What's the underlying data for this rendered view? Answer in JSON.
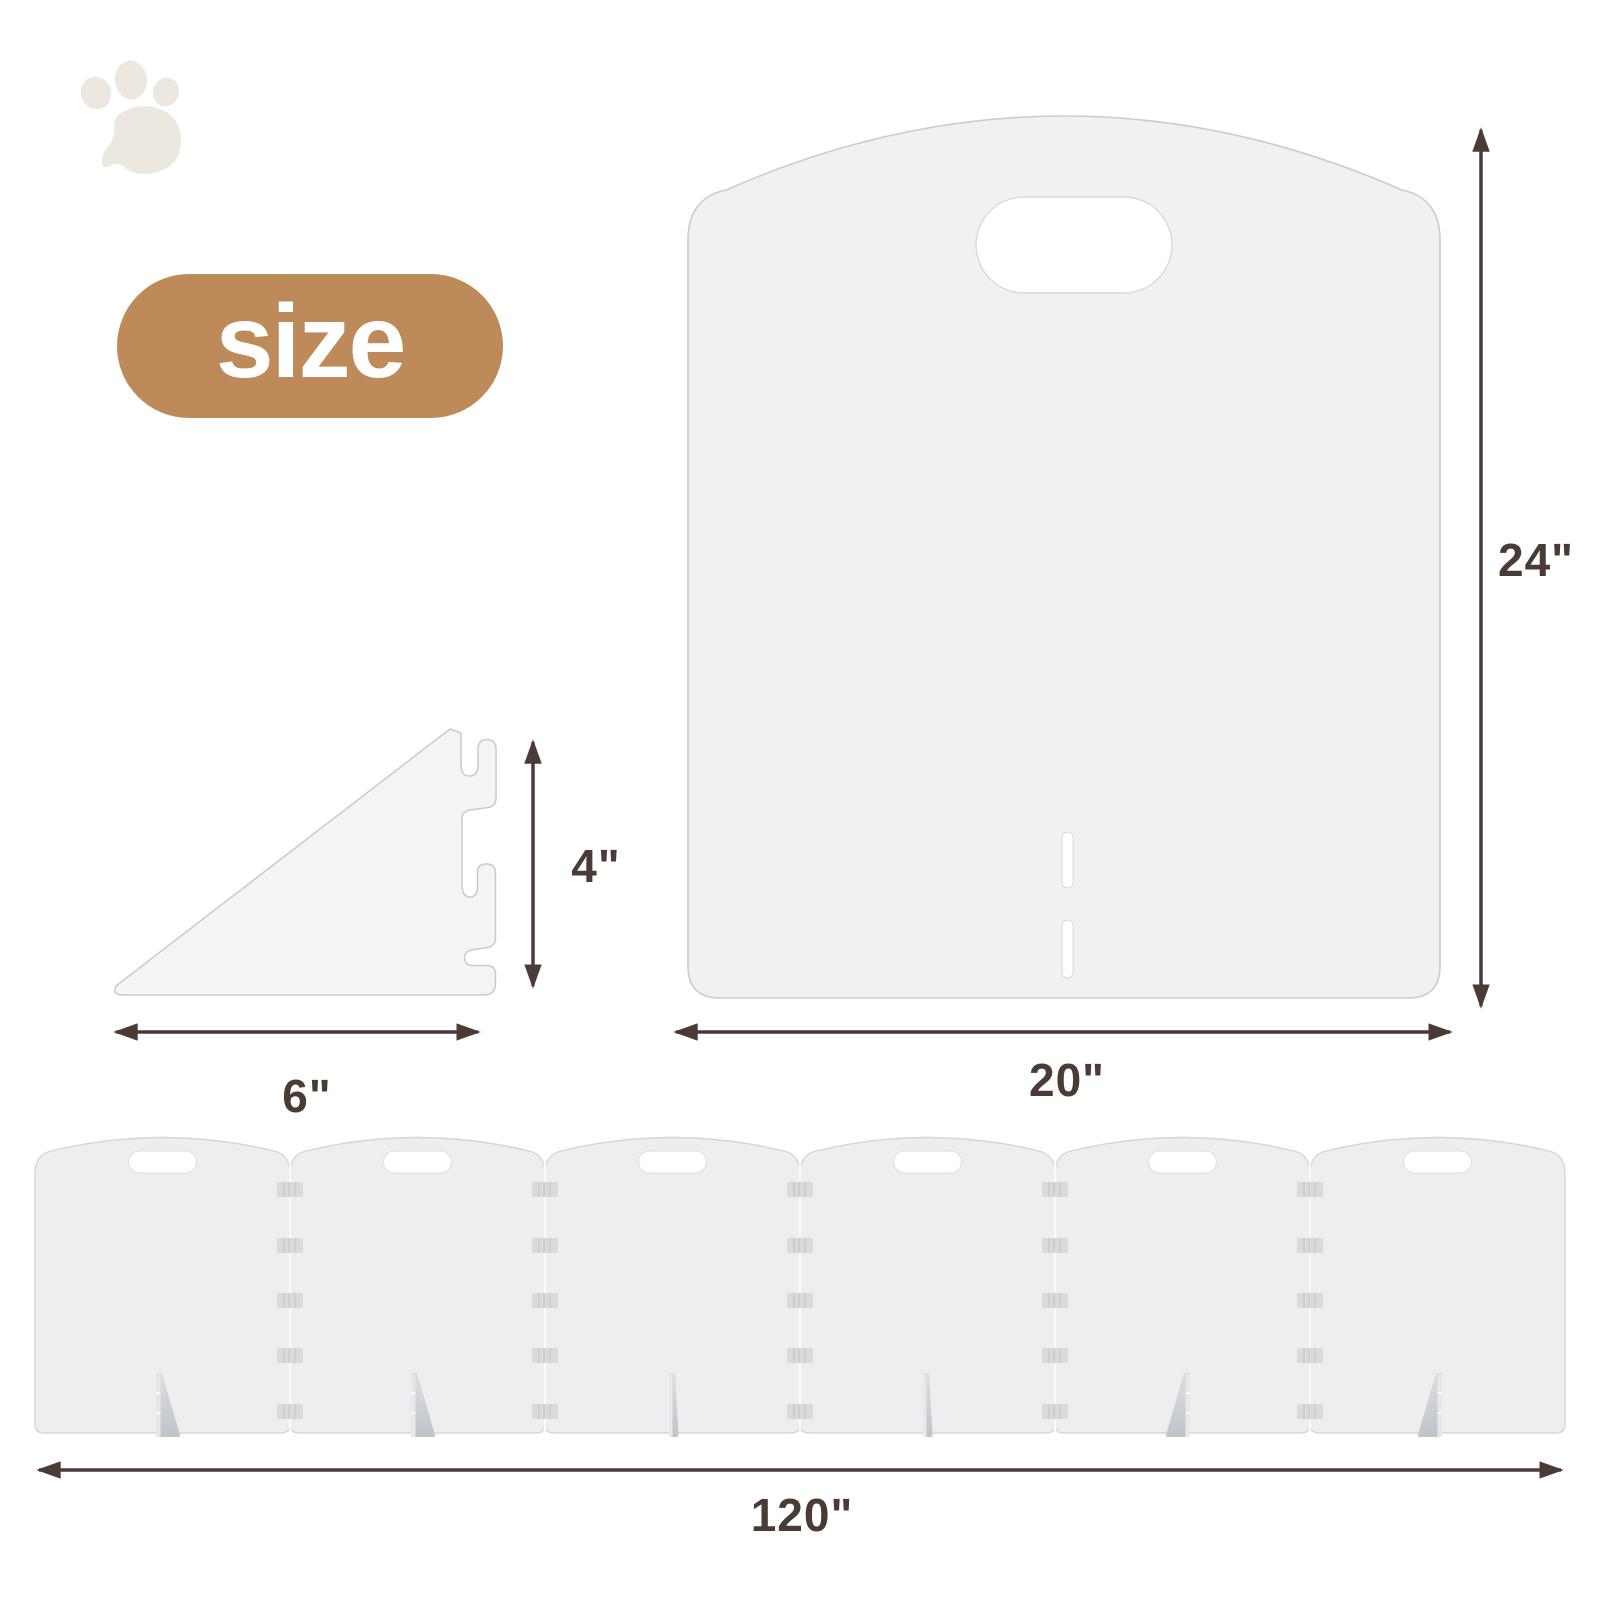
{
  "badge": {
    "label": "size"
  },
  "dimensions": {
    "panel_height": "24\"",
    "panel_width": "20\"",
    "bracket_height": "4\"",
    "bracket_width": "6\"",
    "total_width": "120\""
  },
  "row": {
    "panel_count": 6
  },
  "icons": {
    "paw": "paw-icon"
  },
  "colors": {
    "background": "#FFFFFF",
    "badge_bg": "#BE8A5A",
    "badge_text": "#FFFFFF",
    "dimension_ink": "#4A3C35",
    "panel_fill": "#F1F1F2",
    "panel_stroke": "#CBCCCE",
    "row_panel_fill": "#EDEEEF",
    "foot_gray": "#C5CACF",
    "paw": "#EDE8DF"
  }
}
